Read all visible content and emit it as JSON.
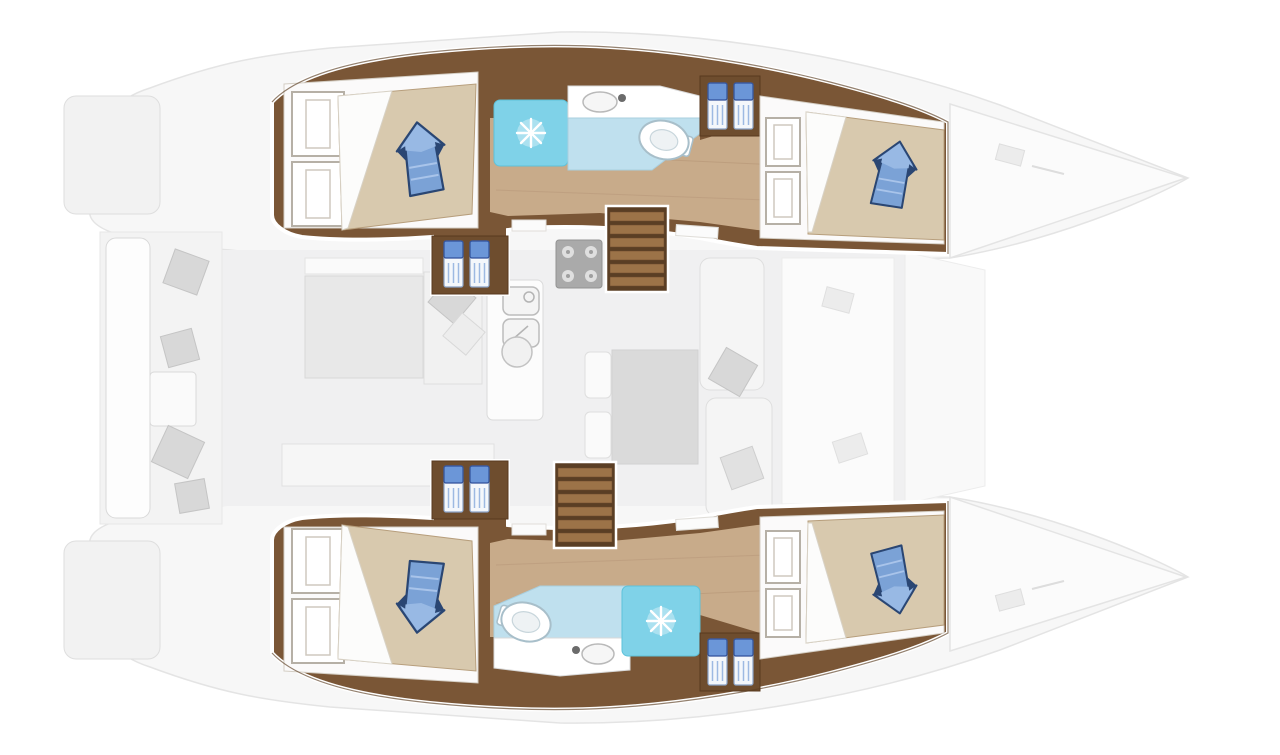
{
  "page": {
    "background": "#ffffff"
  },
  "diagram": {
    "type": "floor-plan",
    "subject": "catamaran-yacht-interior-layout",
    "orientation": "bow-right",
    "highlighted_deck": "hull-cabins",
    "faded_deck": "main-deck-salon-cockpit",
    "colors": {
      "page-bg": "#ffffff",
      "wood-dark": "#7a5636",
      "wood-edge": "#5a3d22",
      "stair-dark": "#5a3e24",
      "stair-tread": "#9c7348",
      "floor-tan": "#c8ab8a",
      "bed-tan": "#d8c9ae",
      "sheet-white": "#fcfcfb",
      "cabin-white": "#fbfafa",
      "pillow-blue": "#7ba2d6",
      "pillow-blue-light": "#98b9e4",
      "pillow-navy": "#2a4673",
      "step-blue": "#6b96d8",
      "shower-cyan": "#7fd2e8",
      "bath-blue": "#bfe0ee",
      "fixture-white": "#ffffff",
      "faded-fill": "#f0f0f1",
      "faded-stroke": "#d9d9d9",
      "pillow-gray": "#d6d6d6",
      "stove-gray": "#a6a6a6"
    },
    "rooms": {
      "port_hull": [
        "aft-cabin-double-bed",
        "head-shower-toilet-washbasin",
        "companionway-steps",
        "staircase",
        "fore-cabin-double-bed"
      ],
      "starboard_hull": [
        "aft-cabin-double-bed",
        "head-shower-toilet-washbasin",
        "companionway-steps",
        "staircase",
        "fore-cabin-double-bed"
      ],
      "main_deck_faded": [
        "aft-cockpit-bench-with-cushions",
        "salon-lounge",
        "galley-stove",
        "galley-double-sink",
        "galley-round-sink",
        "dinette-table-with-seats",
        "foredeck"
      ]
    },
    "feature_counts": {
      "double-beds": 4,
      "blue-pillows": 4,
      "showers": 2,
      "toilets": 2,
      "washbasins": 2,
      "staircases": 2,
      "blue-step-pairs": 4
    }
  }
}
